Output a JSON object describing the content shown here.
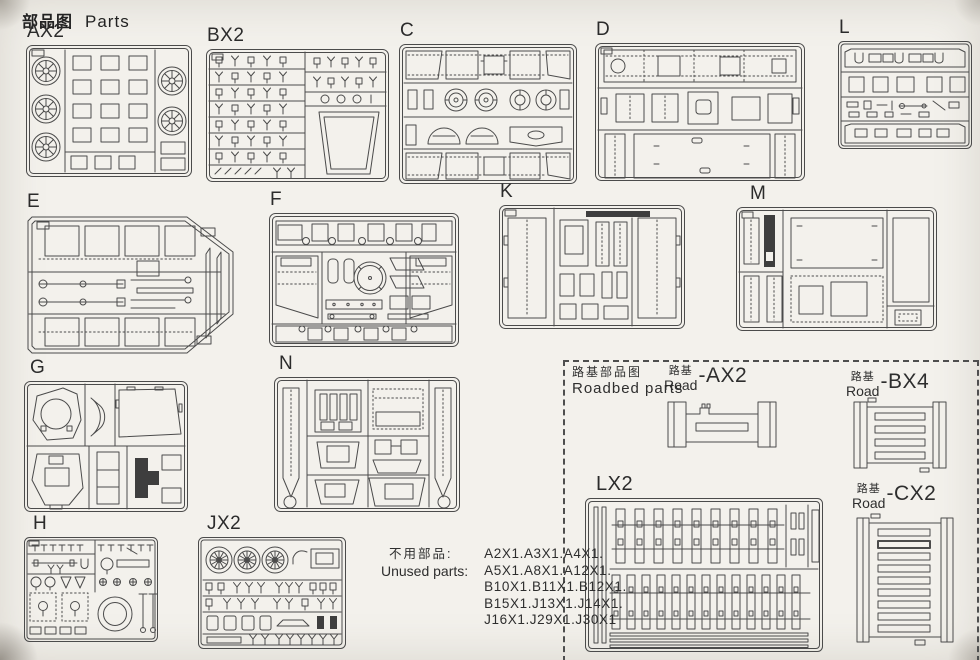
{
  "page": {
    "title_cn": "部品图",
    "title_en": "Parts"
  },
  "sprues": [
    {
      "label": "AX2"
    },
    {
      "label": "BX2"
    },
    {
      "label": "C"
    },
    {
      "label": "D"
    },
    {
      "label": "L"
    },
    {
      "label": "E"
    },
    {
      "label": "F"
    },
    {
      "label": "K"
    },
    {
      "label": "M"
    },
    {
      "label": "G"
    },
    {
      "label": "N"
    },
    {
      "label": "H"
    },
    {
      "label": "JX2"
    }
  ],
  "roadbed": {
    "title_cn": "路基部品图",
    "title_en": "Roadbed parts",
    "sprue_label": "LX2",
    "items": [
      {
        "cn": "路基",
        "en": "Road",
        "code": "-AX2"
      },
      {
        "cn": "路基",
        "en": "Road",
        "code": "-BX4"
      },
      {
        "cn": "路基",
        "en": "Road",
        "code": "-CX2"
      }
    ]
  },
  "unused": {
    "label_cn": "不用部品:",
    "label_en": "Unused parts:",
    "lines": [
      "A2X1.A3X1.A4X1.",
      "A5X1.A8X1.A12X1.",
      "B10X1.B11X1.B12X1.",
      "B15X1.J13X1.J14X1.",
      "J16X1.J29X1.J30X1"
    ]
  },
  "colors": {
    "paper": "#f3f1ec",
    "line": "#4b4b4b",
    "dark_fill": "#3e3e3e"
  }
}
